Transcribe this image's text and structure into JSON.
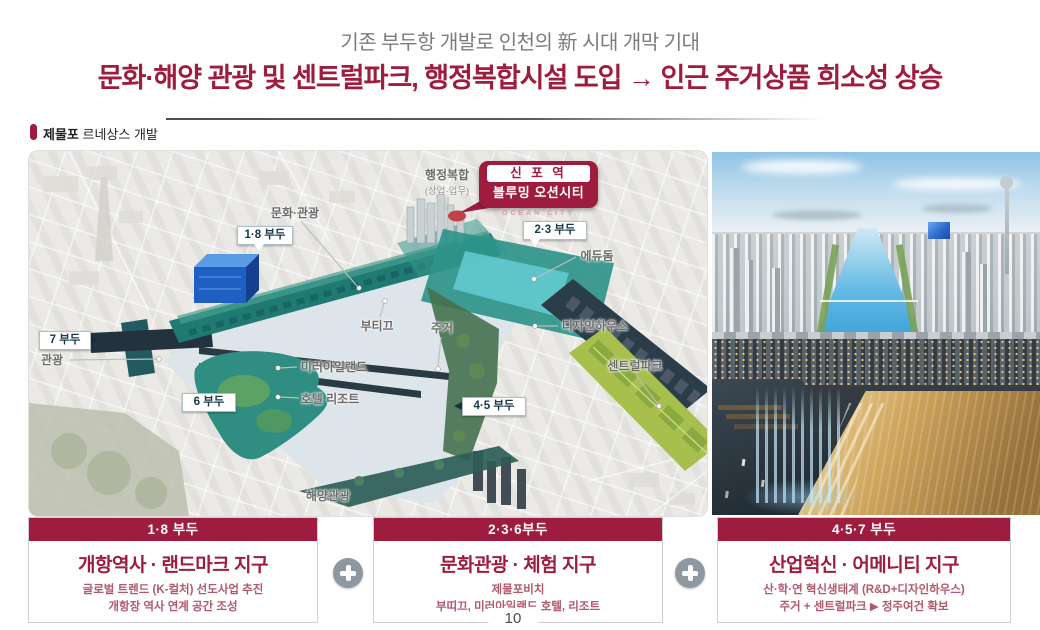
{
  "header": {
    "subtitle": "기존 부두항 개발로 인천의 新 시대 개막 기대",
    "headline": "문화·해양 관광 및 센트럴파크, 행정복합시설 도입 → 인근 주거상품 희소성 상승"
  },
  "section": {
    "label_bold": "제물포",
    "label_rest": " 르네상스 개발"
  },
  "map": {
    "badge": {
      "station": "신 포 역",
      "name": "블루밍 오션시티",
      "sub": "OCEAN CITY"
    },
    "labels": {
      "admin1": "행정복합",
      "admin2": "(상업·업무)",
      "munhwa": "문화·관광",
      "pier18": "1·8 부두",
      "pier23": "2·3 부두",
      "edudome": "에듀돔",
      "pier7": "7 부두",
      "gwangwang": "관광",
      "boutique": "부티끄",
      "jugeo": "주거",
      "design": "디자인하우스",
      "central": "센트럴파크",
      "mirror": "미러아일랜드",
      "hotel": "호텔 리조트",
      "pier6": "6 부두",
      "pier45": "4·5 부두",
      "marine": "해양관광"
    }
  },
  "cards": [
    {
      "header": "1·8 부두",
      "title": "개항역사 · 랜드마크 지구",
      "lines": [
        "글로벌 트렌드 (K-컬처) 선도사업 추진",
        "개항장 역사 연계 공간 조성"
      ]
    },
    {
      "header": "2·3·6부두",
      "title": "문화관광 · 체험 지구",
      "lines": [
        "제물포비치",
        "부띠끄, 미러아일랜드 호텔, 리조트"
      ]
    },
    {
      "header": "4·5·7 부두",
      "title": "산업혁신 · 어메니티 지구",
      "lines": [
        "산·학·연 혁신생태계 (R&D+디자인하우스)",
        "주거 + 센트럴파크 ▶ 정주여건 확보"
      ]
    }
  ],
  "footer": {
    "page": "10"
  },
  "colors": {
    "maroon": "#9e1d3e",
    "teal_pier": "#2e948a",
    "park_green": "#a7bf4d",
    "label_navy": "#14394a"
  }
}
